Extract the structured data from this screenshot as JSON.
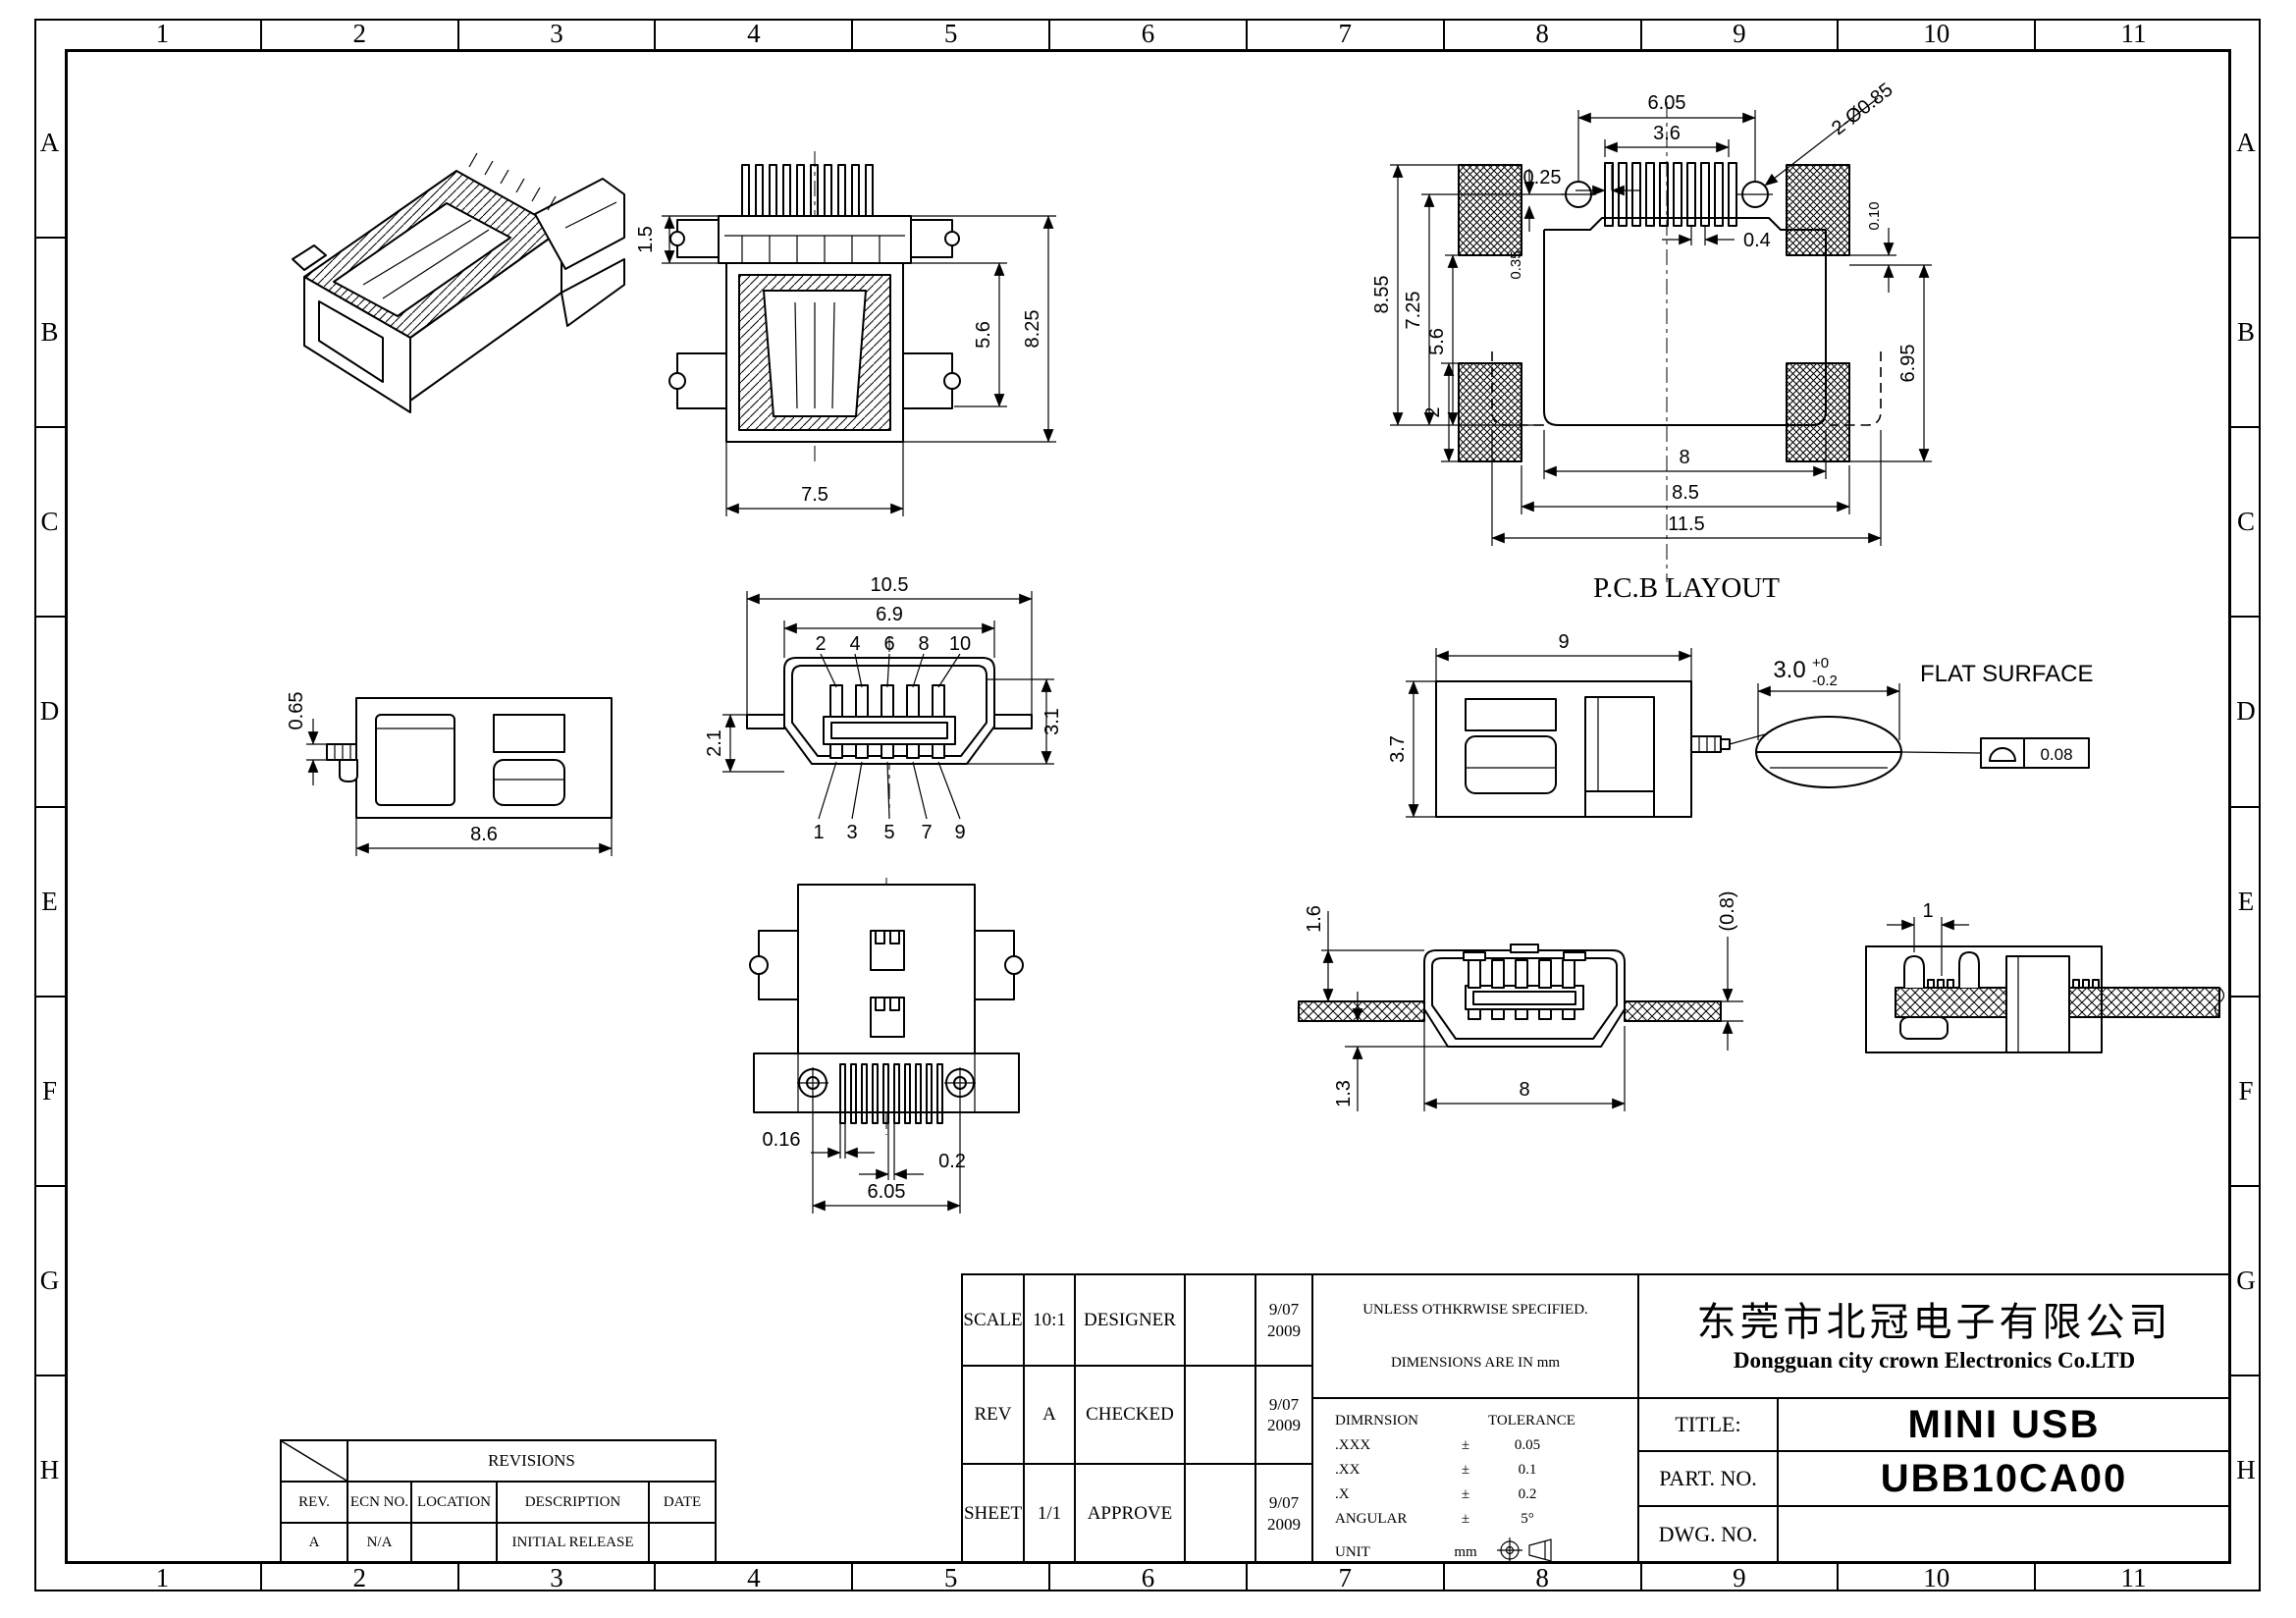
{
  "sheet": {
    "zone_columns": [
      "1",
      "2",
      "3",
      "4",
      "5",
      "6",
      "7",
      "8",
      "9",
      "10",
      "11"
    ],
    "zone_rows": [
      "A",
      "B",
      "C",
      "D",
      "E",
      "F",
      "G",
      "H"
    ]
  },
  "views": {
    "rear": {
      "dims": {
        "cap": "1.5",
        "body": "5.6",
        "overall": "8.25",
        "width": "7.5"
      }
    },
    "pcb": {
      "label": "P.C.B LAYOUT",
      "dims": {
        "hole_span": "6.05",
        "pad_span": "3.6",
        "offset": "0.25",
        "pitch": "0.4",
        "holes": "2-Ø0.85",
        "h_overall": "8.55",
        "h_inner": "7.25",
        "h_pads": "5.6",
        "offset2": "0.35",
        "pad_h": "2",
        "gap": "0.10",
        "h_right": "6.95",
        "w_inner": "8",
        "w_mid": "8.5",
        "w_overall": "11.5"
      }
    },
    "front": {
      "dims": {
        "overall": "10.5",
        "shell": "6.9",
        "left": "2.1",
        "right": "3.1"
      },
      "pins_top": [
        "2",
        "4",
        "6",
        "8",
        "10"
      ],
      "pins_bottom": [
        "1",
        "3",
        "5",
        "7",
        "9"
      ]
    },
    "side_left": {
      "dims": {
        "pin": "0.65",
        "length": "8.6"
      }
    },
    "side_right": {
      "dims": {
        "length": "9",
        "height": "3.7"
      },
      "flat": {
        "value": "3.0",
        "plus": "+0",
        "minus": "-0.2",
        "note": "FLAT SURFACE"
      },
      "flatness": "0.08"
    },
    "bottom": {
      "dims": {
        "pin_w": "0.16",
        "gap": "0.2",
        "span": "6.05"
      }
    },
    "section": {
      "dims": {
        "top": "1.6",
        "pcb": "(0.8)",
        "bottom": "1.3",
        "width": "8"
      }
    },
    "mounted": {
      "dims": {
        "pitch": "1"
      }
    }
  },
  "revisions": {
    "banner": "REVISIONS",
    "headers": [
      "REV.",
      "ECN NO.",
      "LOCATION",
      "DESCRIPTION",
      "DATE"
    ],
    "rows": [
      [
        "A",
        "N/A",
        "",
        "INITIAL RELEASE",
        ""
      ]
    ]
  },
  "title_block": {
    "scale_label": "SCALE",
    "scale_value": "10:1",
    "rev_label": "REV",
    "rev_value": "A",
    "sheet_label": "SHEET",
    "sheet_value": "1/1",
    "designer_label": "DESIGNER",
    "checked_label": "CHECKED",
    "approve_label": "APPROVE",
    "date1_line1": "9/07",
    "date1_line2": "2009",
    "date2_line1": "9/07",
    "date2_line2": "2009",
    "date3_line1": "9/07",
    "date3_line2": "2009",
    "notes_line1": "UNLESS OTHKRWISE SPECIFIED.",
    "notes_line2": "DIMENSIONS ARE IN mm",
    "tol_header_dim": "DIMRNSION",
    "tol_header_tol": "TOLERANCE",
    "tol_rows": [
      [
        ".XXX",
        "±",
        "0.05"
      ],
      [
        ".XX",
        "±",
        "0.1"
      ],
      [
        ".X",
        "±",
        "0.2"
      ],
      [
        "ANGULAR",
        "±",
        "5°"
      ],
      [
        "UNIT",
        "mm",
        ""
      ]
    ],
    "company_cn": "东莞市北冠电子有限公司",
    "company_en": "Dongguan city crown Electronics Co.LTD",
    "title_label": "TITLE:",
    "title_value": "MINI USB",
    "part_label": "PART. NO.",
    "part_value": "UBB10CA00",
    "dwg_label": "DWG. NO.",
    "dwg_value": ""
  }
}
